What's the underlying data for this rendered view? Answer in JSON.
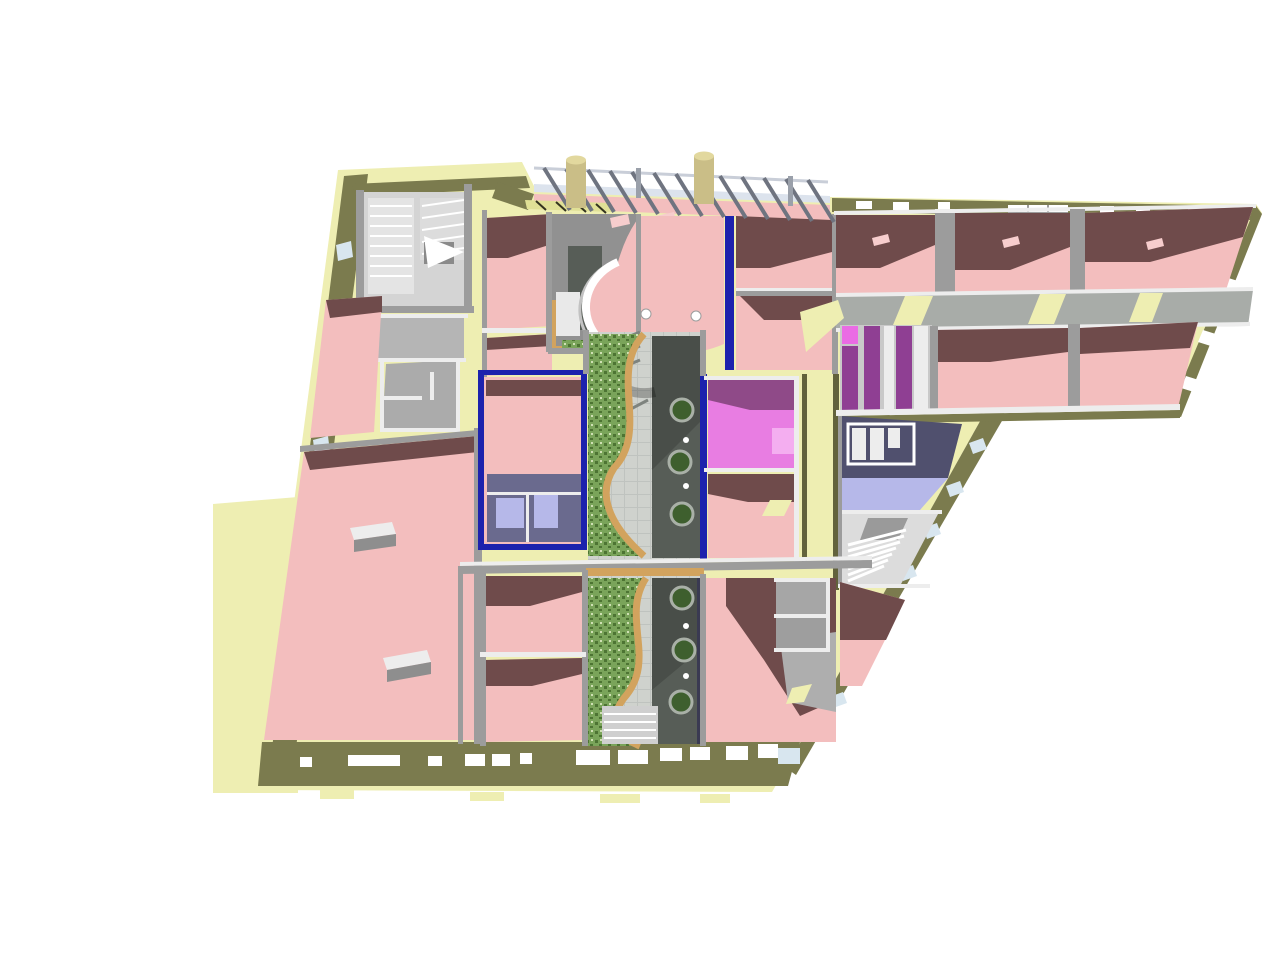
{
  "scene": {
    "title": "Axonometric 3D cutaway floor-plan rendering of a building complex",
    "background": "#ffffff",
    "counts": {
      "upper_courtyard_planters": 3,
      "lower_courtyard_planters": 3,
      "left_facade_windows": 8,
      "canopy_beams": 13,
      "chimneys": 2
    }
  },
  "colors": {
    "slab": "#eeeeb2",
    "slab_dark": "#e0e096",
    "olive": "#7b7b4e",
    "olive_dark": "#62623c",
    "wall_gray": "#9c9c9c",
    "wall_gray_dark": "#7f7f7f",
    "wall_white": "#ededed",
    "floor_gray": "#919191",
    "floor_gray_light": "#b5b5b5",
    "tile_dark": "#575d57",
    "tile_white": "#e9e9e9",
    "pink": "#f3bebe",
    "pink_light": "#f7cdcd",
    "maroon": "#6f4b4b",
    "magenta": "#e87de2",
    "magenta_dark": "#8f4a88",
    "magenta_light": "#f4aef0",
    "purple_stripe": "#8f3f93",
    "magenta_stripe": "#ea6ce4",
    "lavender": "#b6b8e9",
    "navy": "#50506e",
    "blue": "#1c22ad",
    "navy_wall": "#3a3a52",
    "garden": "#7aa45a",
    "garden_dark": "#4d7433",
    "tan": "#d2a35e",
    "walk": "#cfd2cd",
    "walk_line": "#bfc3bf",
    "planter": "#3e5f2e",
    "planter_rim": "#a9b0a7",
    "canopy": "#dce3ed",
    "beam": "#6f7480",
    "chimney": "#cabe87",
    "chimney_top": "#e2d89e",
    "glass": "#d8e6ef",
    "mint": "#cfe4b4",
    "stair": "#d4d4d4",
    "shadow": "rgba(0,0,0,0.16)",
    "dash": "#33331f",
    "white": "#ffffff"
  },
  "regions": [
    {
      "id": "exterior-ground",
      "label": "pale yellow ground slab and sidewalk",
      "color": "slab"
    },
    {
      "id": "perimeter-wall",
      "label": "olive perimeter walls with window slits",
      "color": "olive"
    },
    {
      "id": "pink-rooms",
      "label": "pink-floored rooms throughout both wings",
      "color": "pink"
    },
    {
      "id": "room-shadows",
      "label": "dark maroon cast shadows on room floors",
      "color": "maroon"
    },
    {
      "id": "upper-garden-courtyard",
      "label": "upper courtyard garden with curved tan path",
      "color": "garden"
    },
    {
      "id": "lower-garden-courtyard",
      "label": "lower courtyard garden with curved tan path",
      "color": "garden"
    },
    {
      "id": "courtyard-walkway",
      "label": "gray tiled walkway with round green planters",
      "color": "walk"
    },
    {
      "id": "curved-balcony",
      "label": "curved white balcony railing over central atrium",
      "color": "pink"
    },
    {
      "id": "blue-walls",
      "label": "royal blue partition walls around courtyard rooms",
      "color": "blue"
    },
    {
      "id": "magenta-room",
      "label": "bright magenta room east of upper courtyard",
      "color": "magenta"
    },
    {
      "id": "striped-washroom",
      "label": "purple striped stall room in east wing",
      "color": "purple_stripe"
    },
    {
      "id": "lavender-bathroom",
      "label": "lavender bathroom fixtures on navy floor",
      "color": "lavender"
    },
    {
      "id": "shelf-room",
      "label": "navy room with white shelving units",
      "color": "navy"
    },
    {
      "id": "stairwells",
      "label": "NW U-stair, SE stair and central spiral stair",
      "color": "stair"
    },
    {
      "id": "east-wing",
      "label": "east wing: two room rows on central corridor",
      "color": "pink"
    },
    {
      "id": "glass-canopy",
      "label": "north glass canopy with beams and two chimneys",
      "color": "canopy"
    }
  ]
}
